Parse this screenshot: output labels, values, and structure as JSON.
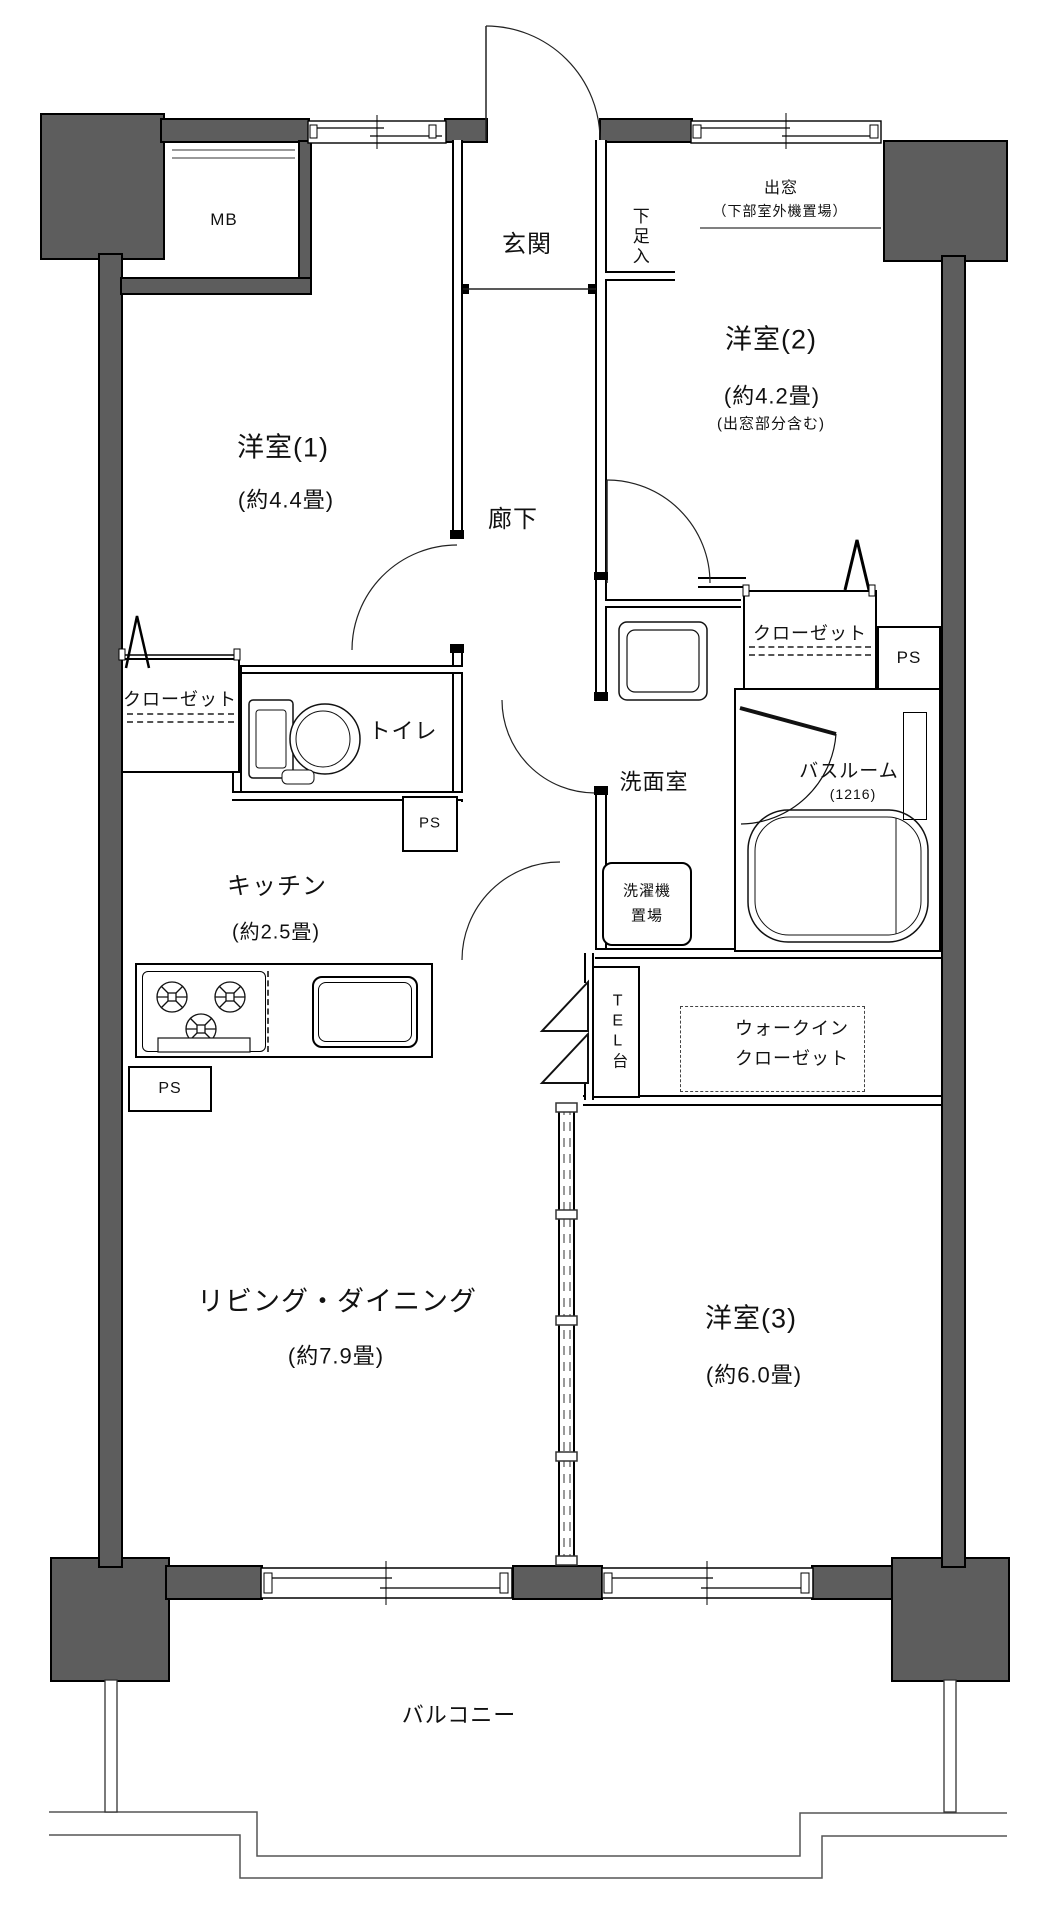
{
  "plan": {
    "colors": {
      "wall_fill": "#5d5d5d",
      "line": "#000000",
      "background": "#ffffff"
    },
    "rooms": {
      "bedroom1": {
        "name": "洋室(1)",
        "size": "(約4.4畳)"
      },
      "bedroom2": {
        "name": "洋室(2)",
        "size": "(約4.2畳)",
        "note": "(出窓部分含む)"
      },
      "bedroom3": {
        "name": "洋室(3)",
        "size": "(約6.0畳)"
      },
      "living_dining": {
        "name": "リビング・ダイニング",
        "size": "(約7.9畳)"
      },
      "kitchen": {
        "name": "キッチン",
        "size": "(約2.5畳)"
      },
      "corridor": {
        "name": "廊下"
      },
      "entrance": {
        "name": "玄関"
      },
      "shoe_cabinet": {
        "name": "下足入"
      },
      "bay_window": {
        "name": "出窓",
        "note": "（下部室外機置場）"
      },
      "washroom": {
        "name": "洗面室"
      },
      "bathroom": {
        "name": "バスルーム",
        "size": "(1216)"
      },
      "laundry": {
        "line1": "洗濯機",
        "line2": "置場"
      },
      "toilet": {
        "name": "トイレ"
      },
      "closet_bedroom1": {
        "name": "クローゼット"
      },
      "closet_bedroom2": {
        "name": "クローゼット"
      },
      "walk_in_closet": {
        "line1": "ウォークイン",
        "line2": "クローゼット"
      },
      "tel_stand": {
        "name": "TEL台"
      },
      "meter_box": {
        "name": "MB"
      },
      "balcony": {
        "name": "バルコニー"
      },
      "pipe_space": {
        "name": "PS"
      }
    }
  }
}
